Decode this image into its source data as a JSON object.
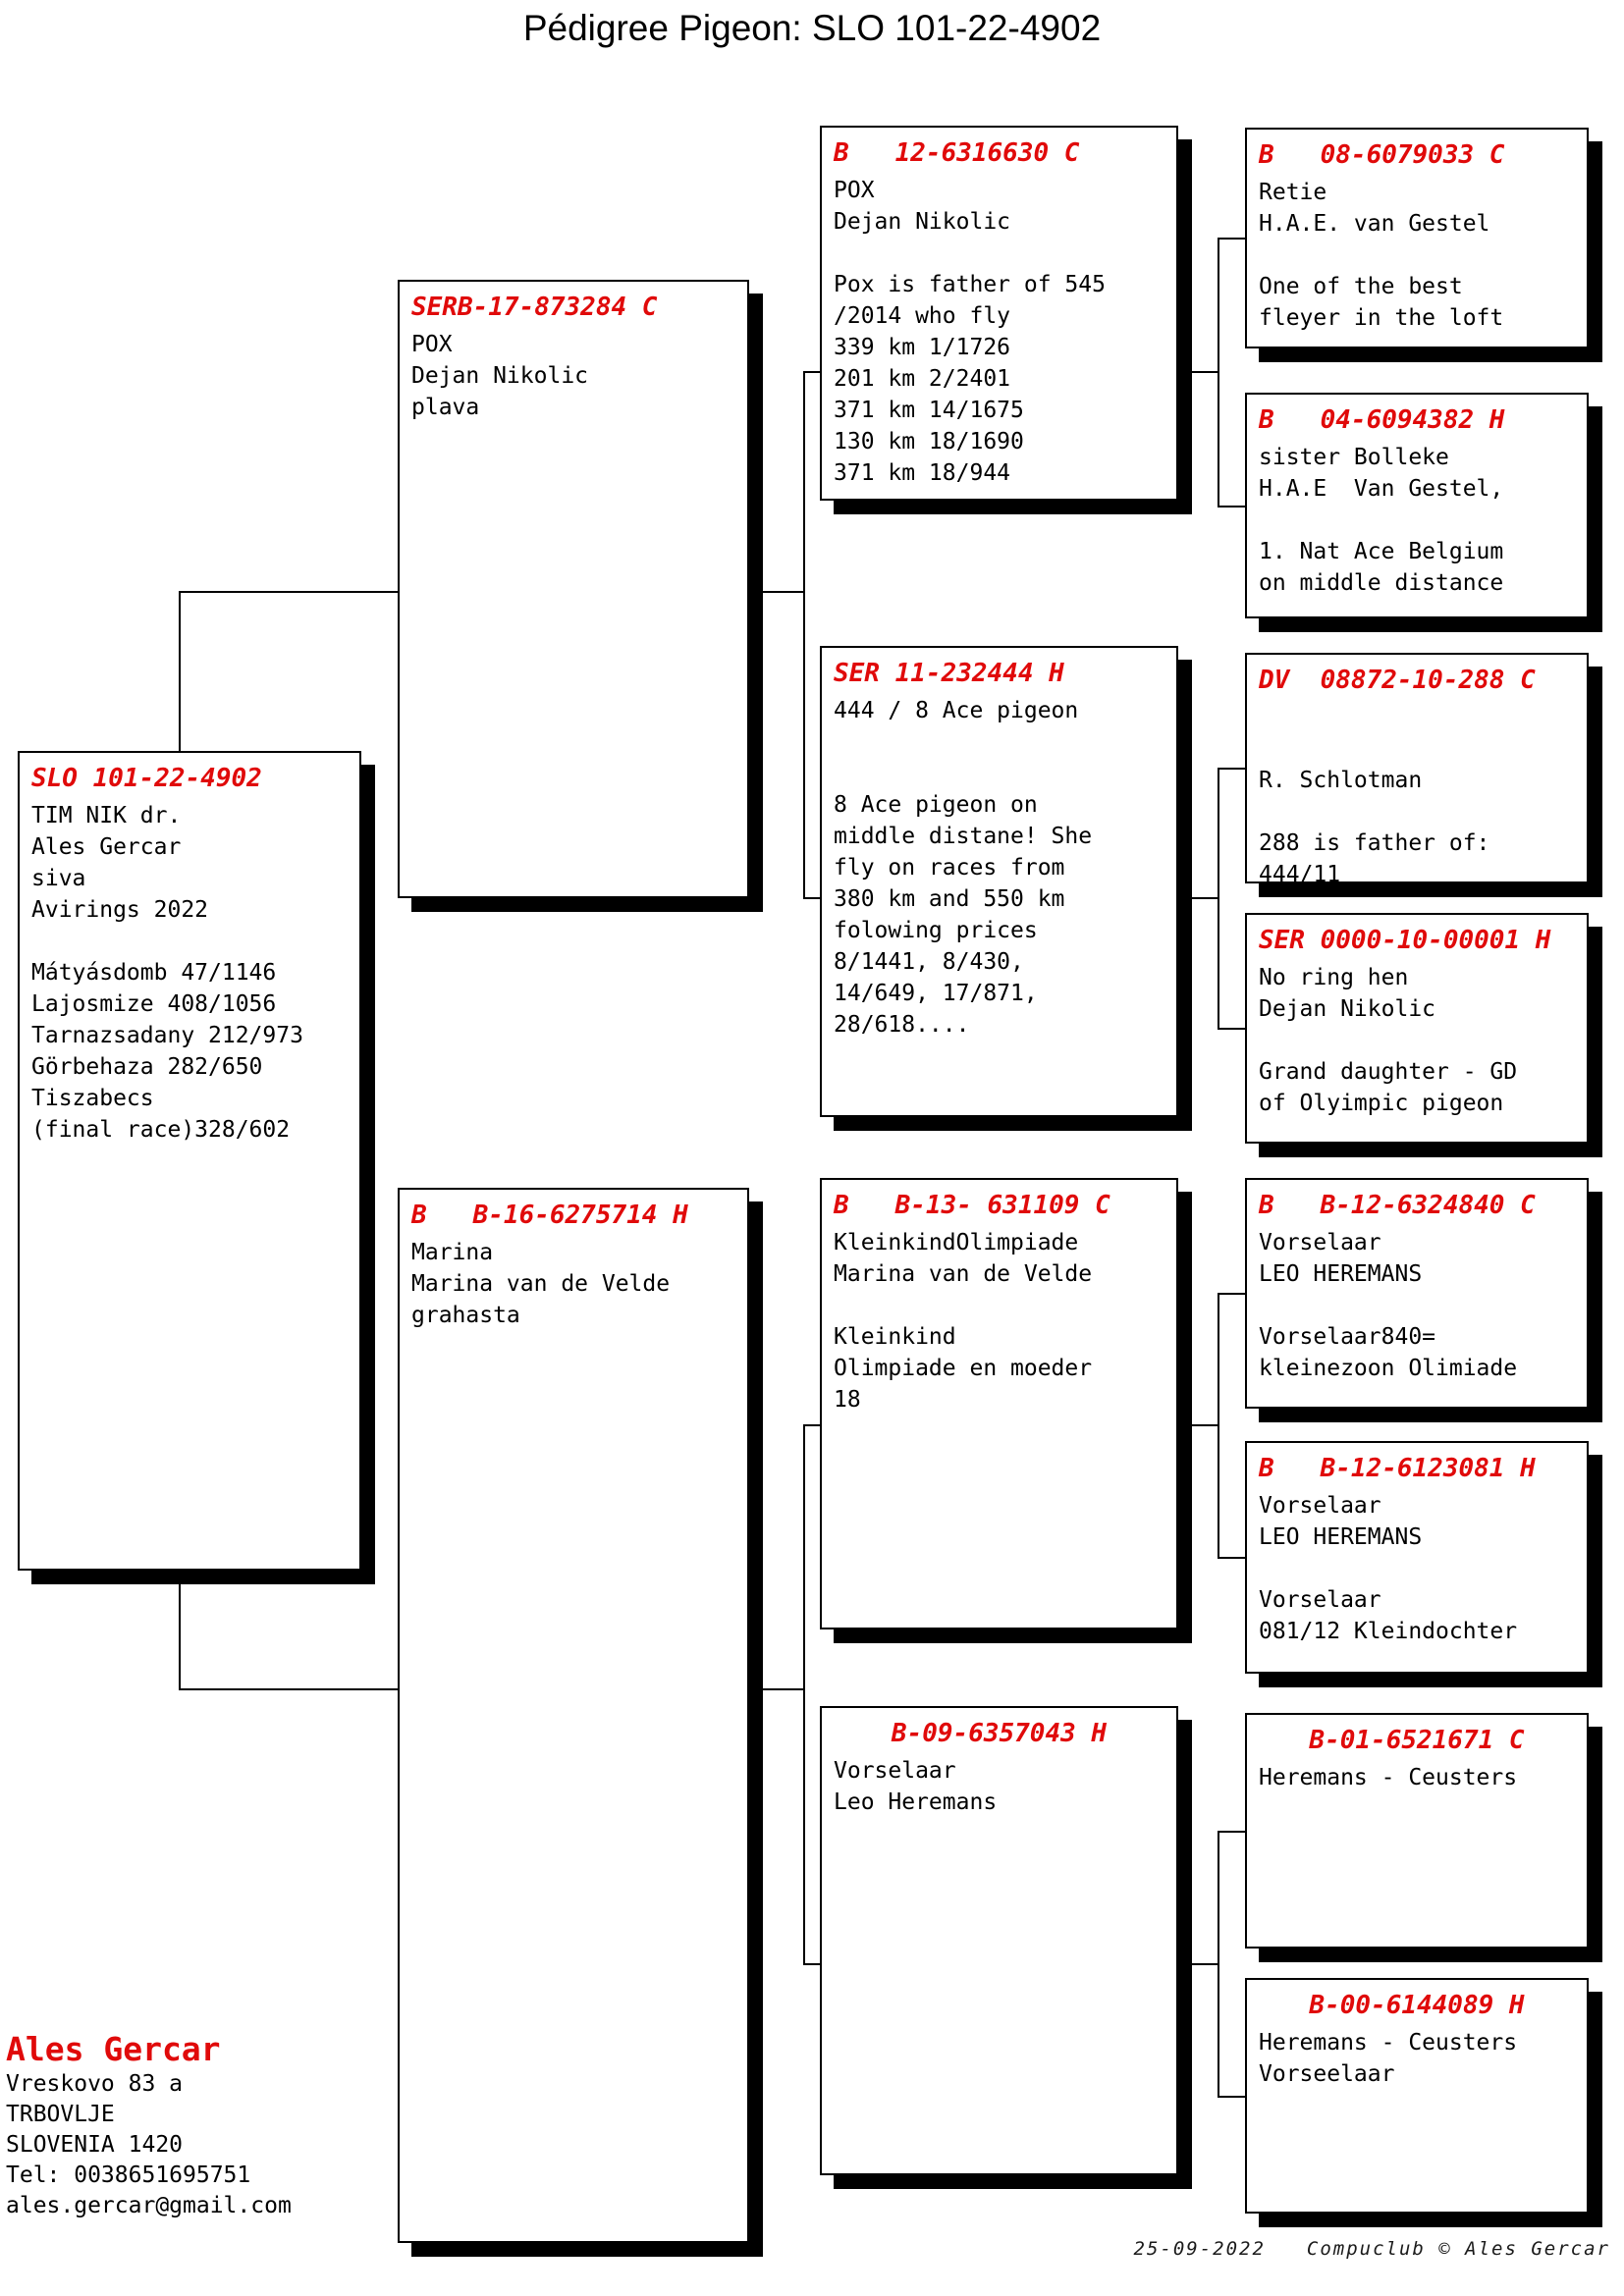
{
  "page_title": "Pédigree Pigeon: SLO 101-22-4902",
  "boxes": [
    {
      "id": "subject-pigeon",
      "title": "SLO 101-22-4902",
      "body": "TIM NIK dr.\nAles Gercar\nsiva\nAvirings 2022\n\nMátyásdomb 47/1146\nLajosmize 408/1056\nTarnazsadany 212/973\nGörbehaza 282/650\nTiszabecs\n(final race)328/602"
    },
    {
      "id": "father",
      "title": "SERB-17-873284 C",
      "body": "POX\nDejan Nikolic\nplava"
    },
    {
      "id": "mother",
      "title": "B   B-16-6275714 H",
      "body": "Marina\nMarina van de Velde\ngrahasta"
    },
    {
      "id": "paternal-grandfather",
      "title": "B   12-6316630 C",
      "body": "POX\nDejan Nikolic\n\nPox is father of 545\n/2014 who fly\n339 km 1/1726\n201 km 2/2401\n371 km 14/1675\n130 km 18/1690\n371 km 18/944"
    },
    {
      "id": "paternal-grandmother",
      "title": "SER 11-232444 H",
      "body": "444 / 8 Ace pigeon\n\n\n8 Ace pigeon on\nmiddle distane! She\nfly on races from\n380 km and 550 km\nfolowing prices\n8/1441, 8/430,\n14/649, 17/871,\n28/618...."
    },
    {
      "id": "maternal-grandfather",
      "title": "B   B-13- 631109 C",
      "body": "KleinkindOlimpiade\nMarina van de Velde\n\nKleinkind\nOlimpiade en moeder\n18"
    },
    {
      "id": "maternal-grandmother",
      "title": "B-09-6357043 H",
      "body": "Vorselaar\nLeo Heremans"
    },
    {
      "id": "great-grandparent-1",
      "title": "B   08-6079033 C",
      "body": "Retie\nH.A.E. van Gestel\n\nOne of the best\nfleyer in the loft"
    },
    {
      "id": "great-grandparent-2",
      "title": "B   04-6094382 H",
      "body": "sister Bolleke\nH.A.E  Van Gestel,\n\n1. Nat Ace Belgium\non middle distance"
    },
    {
      "id": "great-grandparent-3",
      "title": "DV  08872-10-288 C",
      "body": "\n\nR. Schlotman\n\n288 is father of:\n444/11"
    },
    {
      "id": "great-grandparent-4",
      "title": "SER 0000-10-00001 H",
      "body": "No ring hen\nDejan Nikolic\n\nGrand daughter - GD\nof Olyimpic pigeon"
    },
    {
      "id": "great-grandparent-5",
      "title": "B   B-12-6324840 C",
      "body": "Vorselaar\nLEO HEREMANS\n\nVorselaar840=\nkleinezoon Olimiade"
    },
    {
      "id": "great-grandparent-6",
      "title": "B   B-12-6123081 H",
      "body": "Vorselaar\nLEO HEREMANS\n\nVorselaar\n081/12 Kleindochter"
    },
    {
      "id": "great-grandparent-7",
      "title": "B-01-6521671 C",
      "body": "Heremans - Ceusters"
    },
    {
      "id": "great-grandparent-8",
      "title": "B-00-6144089 H",
      "body": "Heremans - Ceusters\nVorseelaar"
    }
  ],
  "contact": {
    "name": "Ales Gercar",
    "address": "Vreskovo 83 a\nTRBOVLJE\nSLOVENIA 1420\nTel: 0038651695751\nales.gercar@gmail.com"
  },
  "footer": {
    "date": "25-09-2022",
    "credit": "Compuclub © Ales Gercar"
  },
  "colors": {
    "accent_red": "#e00a0a",
    "line_black": "#000000"
  }
}
